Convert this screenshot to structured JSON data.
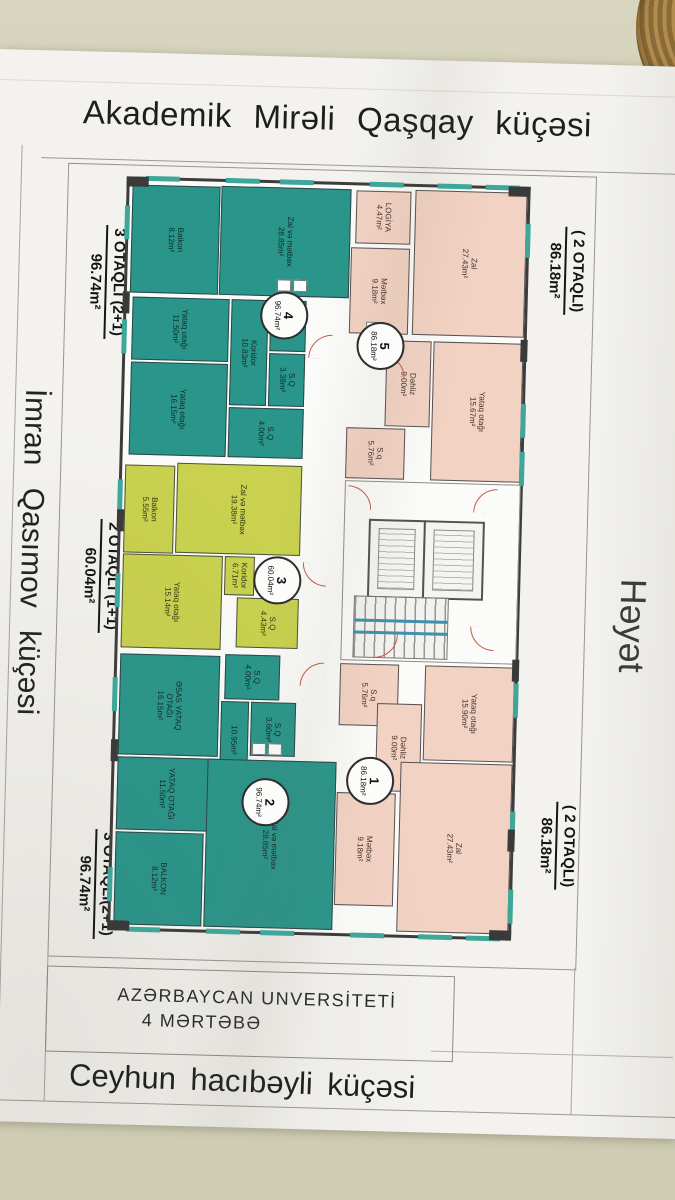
{
  "scene": {
    "wall_color": "#d4d1ba",
    "paper_color": "#f3f2ee",
    "object_top_right": "wicker-basket"
  },
  "streets": {
    "top": "Akademik  Mirəli  Qaşqay  küçəsi",
    "left": "İmran  Qasımov  küçəsi",
    "right": "Həyət",
    "bottom": "Ceyhun hacıbəyli  küçəsi"
  },
  "building_note": {
    "line1": "AZƏRBAYCAN  UNVERSİTETİ",
    "line2": "4 MƏRTƏBƏ"
  },
  "colors": {
    "teal_apartment": "#2a968b",
    "lime_apartment": "#c9d14f",
    "pink_apartment": "#f2d2c3",
    "wall_line": "#3c3c3c",
    "window_mark": "#3fa79a",
    "door_arc": "#c4574a",
    "stair_rail": "#3f8fae"
  },
  "apartments": [
    {
      "id": "apt4",
      "badge": {
        "num": "4",
        "area": "96.74m²"
      },
      "side_label": {
        "type": "3 OTAQLI (2+1)",
        "area": "96.74m²"
      },
      "rooms": [
        {
          "name": "Balkon",
          "area": "8.12m²"
        },
        {
          "name": "Zal və mətbəx",
          "area": "28.85m²"
        },
        {
          "name": "Yataq otağı",
          "area": "11.50m²"
        },
        {
          "name": "Yataq otağı",
          "area": "16.15m²"
        },
        {
          "name": "Koridor",
          "area": "10.83m²"
        },
        {
          "name": "S.Q",
          "area": "3.38m²"
        },
        {
          "name": "S.Q",
          "area": "4.00m²"
        }
      ]
    },
    {
      "id": "apt5",
      "badge": {
        "num": "5",
        "area": "86.18m²"
      },
      "side_label": {
        "type": "( 2 OTAQLI)",
        "area": "86.18m²"
      },
      "rooms": [
        {
          "name": "LOGİYA",
          "area": "4.47m²"
        },
        {
          "name": "Mətbəx",
          "area": "9.18m²"
        },
        {
          "name": "Zal",
          "area": "27.43m²"
        },
        {
          "name": "Dəhliz",
          "area": "9.00m²"
        },
        {
          "name": "Yataq otağı",
          "area": "15.67m²"
        },
        {
          "name": "S.q",
          "area": "5.76m²"
        }
      ]
    },
    {
      "id": "apt3",
      "badge": {
        "num": "3",
        "area": "60.04m²"
      },
      "side_label": {
        "type": "2 OTAQLI (1+1)",
        "area": "60.04m²"
      },
      "rooms": [
        {
          "name": "Balkon",
          "area": "5.55m²"
        },
        {
          "name": "Zal və mətbəx",
          "area": "19.38m²"
        },
        {
          "name": "Yataq otağı",
          "area": "15.14m²"
        },
        {
          "name": "Koridor",
          "area": "6.71m²"
        },
        {
          "name": "S.Q",
          "area": "4.43m²"
        }
      ]
    },
    {
      "id": "apt2",
      "badge": {
        "num": "2",
        "area": "96.74m²"
      },
      "side_label": {
        "type": "3 OTAQLI(2+1)",
        "area": "96.74m²"
      },
      "rooms": [
        {
          "name": "S.Q",
          "area": "4.00m²"
        },
        {
          "name": "ƏSAS YATAQ OTAĞI",
          "area": "16.15m²"
        },
        {
          "name": "S.Q",
          "area": "3.60m²"
        },
        {
          "name": "",
          "area": "10.95m²"
        },
        {
          "name": "YATAQ OTAĞI",
          "area": "11.50m²"
        },
        {
          "name": "BALKON",
          "area": "8.12m²"
        },
        {
          "name": "Zal və mətbəx",
          "area": "28.85m²"
        }
      ]
    },
    {
      "id": "apt1",
      "badge": {
        "num": "1",
        "area": "86.18m²"
      },
      "side_label": {
        "type": "( 2 OTAQLI)",
        "area": "86.18m²"
      },
      "rooms": [
        {
          "name": "S.q",
          "area": "5.76m²"
        },
        {
          "name": "Yataq otağı",
          "area": "15.90m²"
        },
        {
          "name": "Dəhliz",
          "area": "9.00m²"
        },
        {
          "name": "Zal",
          "area": "27.43m²"
        },
        {
          "name": "Mətbəx",
          "area": "9.18m²"
        }
      ]
    }
  ]
}
